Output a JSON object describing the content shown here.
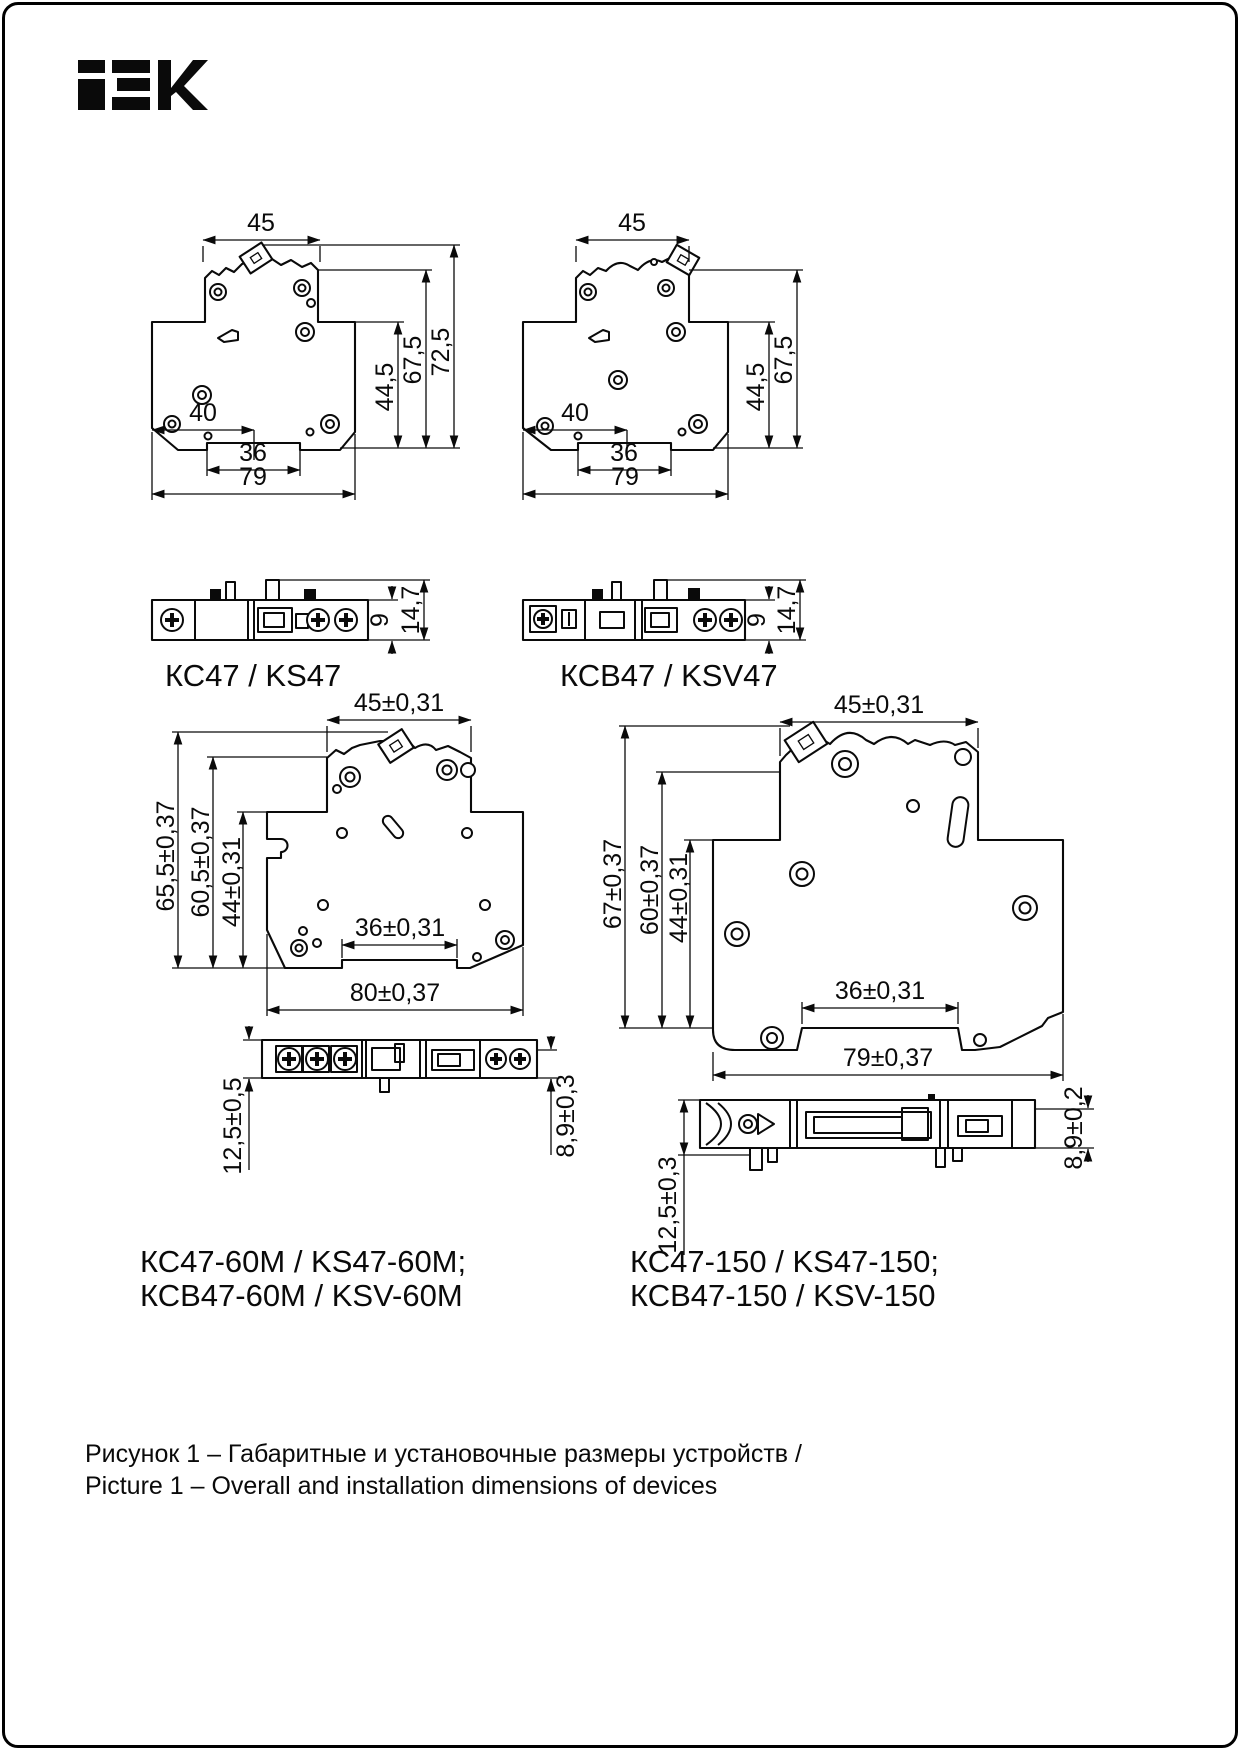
{
  "logo": {
    "brand": "IEK"
  },
  "figures": {
    "kc47": {
      "name": "КС47 / KS47",
      "dims": {
        "top_width": "45",
        "center_offset": "40",
        "rail_slot": "36",
        "overall_width": "79",
        "lower_height": "44,5",
        "upper_height": "67,5",
        "total_height": "72,5",
        "side_body": "9",
        "side_total": "14,7"
      }
    },
    "ksv47": {
      "name": "КСВ47 / KSV47",
      "dims": {
        "top_width": "45",
        "center_offset": "40",
        "rail_slot": "36",
        "overall_width": "79",
        "lower_height": "44,5",
        "upper_height": "67,5",
        "side_body": "9",
        "side_total": "14,7"
      }
    },
    "kc47_60m": {
      "name_line1": "КС47-60М / KS47-60M;",
      "name_line2": "КСВ47-60М / KSV-60M",
      "dims": {
        "top_width": "45±0,31",
        "total_height": "65,5±0,37",
        "upper_height": "60,5±0,37",
        "lower_height": "44±0,31",
        "rail_slot": "36±0,31",
        "overall_width": "80±0,37",
        "side_height": "12,5±0,5",
        "side_depth": "8,9±0,3"
      }
    },
    "kc47_150": {
      "name_line1": "КС47-150 / KS47-150;",
      "name_line2": "КСВ47-150 / KSV-150",
      "dims": {
        "top_width": "45±0,31",
        "total_height": "67±0,37",
        "upper_height": "60±0,37",
        "lower_height": "44±0,31",
        "rail_slot": "36±0,31",
        "overall_width": "79±0,37",
        "side_height": "12,5±0,3",
        "side_depth": "8,9±0,2"
      }
    }
  },
  "caption": {
    "ru": "Рисунок 1 – Габаритные и установочные размеры устройств /",
    "en": "Picture 1 – Overall and installation dimensions of devices"
  }
}
